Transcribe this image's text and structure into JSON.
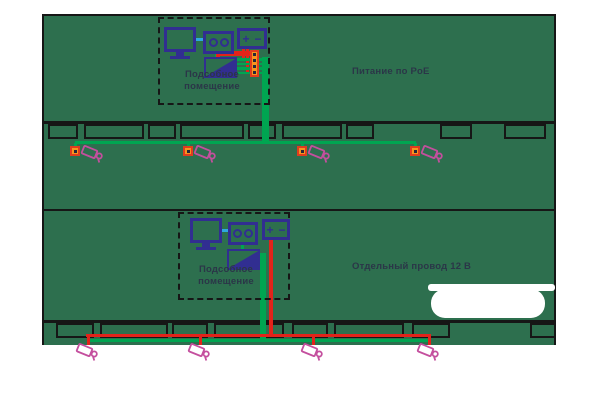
{
  "schemes": {
    "top": {
      "caption": "Питание по PoE",
      "room_label": "Подсобное помещение",
      "camera_count": 4
    },
    "bottom": {
      "caption": "Отдельный провод 12 В",
      "room_label": "Подсобное помещение",
      "camera_count": 4
    }
  },
  "equipment_labels": {
    "psu_plus": "+",
    "psu_minus": "−"
  },
  "icons": {
    "monitor": "monitor-icon",
    "recorder": "recorder-icon",
    "power_supply": "power-supply-icon",
    "network_switch": "switch-icon",
    "patch_panel": "patch-panel-icon",
    "junction_box": "junction-box-icon",
    "camera": "camera-icon"
  },
  "colors": {
    "building_green": "#2d6f4e",
    "wire_green": "#00a551",
    "wire_red": "#e2231a",
    "equipment_blue": "#312e91",
    "link_cyan": "#2fa8df",
    "camera_magenta": "#c44f9e",
    "junction_orange": "#f7941e",
    "strip_border": "#e03c1e",
    "line_black": "#161616",
    "text_dark": "#2b3648"
  }
}
